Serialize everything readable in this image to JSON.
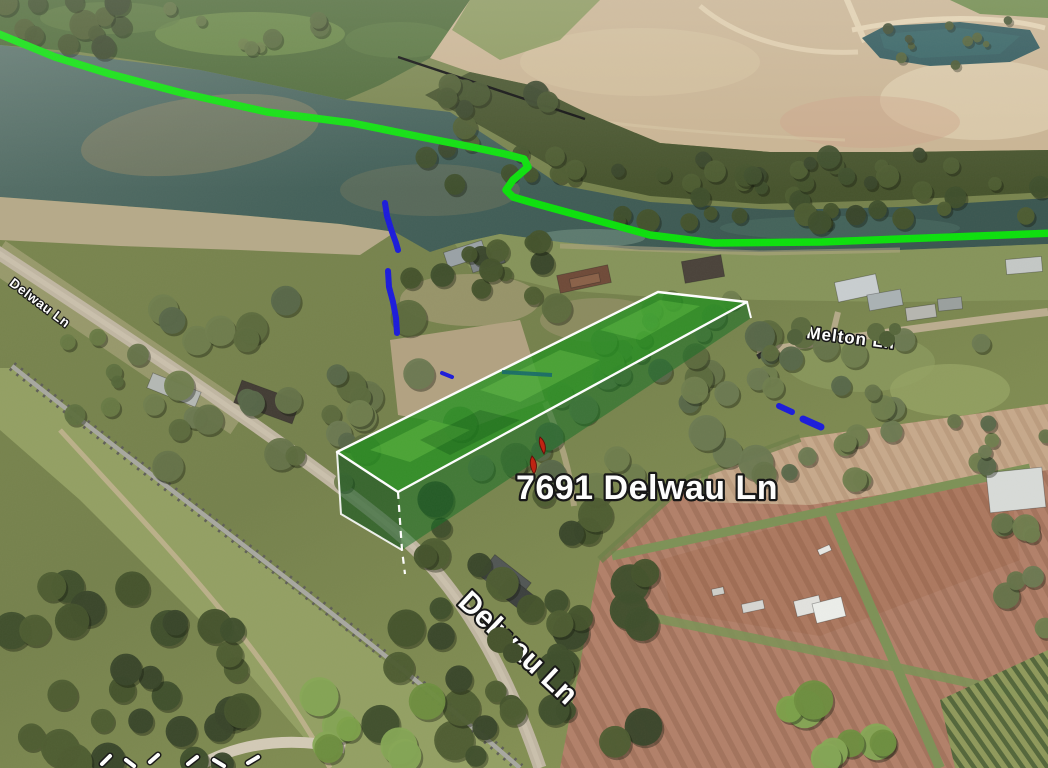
{
  "map": {
    "view_type": "3d-aerial-imagery",
    "property_label": "7691 Delwau Ln",
    "road_label_bottom": "Delwau Ln",
    "road_label_left": "Delwau Ln",
    "road_label_right": "Melton Ln"
  },
  "annotations": {
    "river_boundary_line_color": "#0ce00c",
    "creek_mark_color": "#1b1bdb",
    "parcel_fill_color": "#2a9427",
    "parcel_outline_color": "#ffffff",
    "survey_line_color": "#0d0d0d",
    "red_mark_color": "#c0200f"
  }
}
